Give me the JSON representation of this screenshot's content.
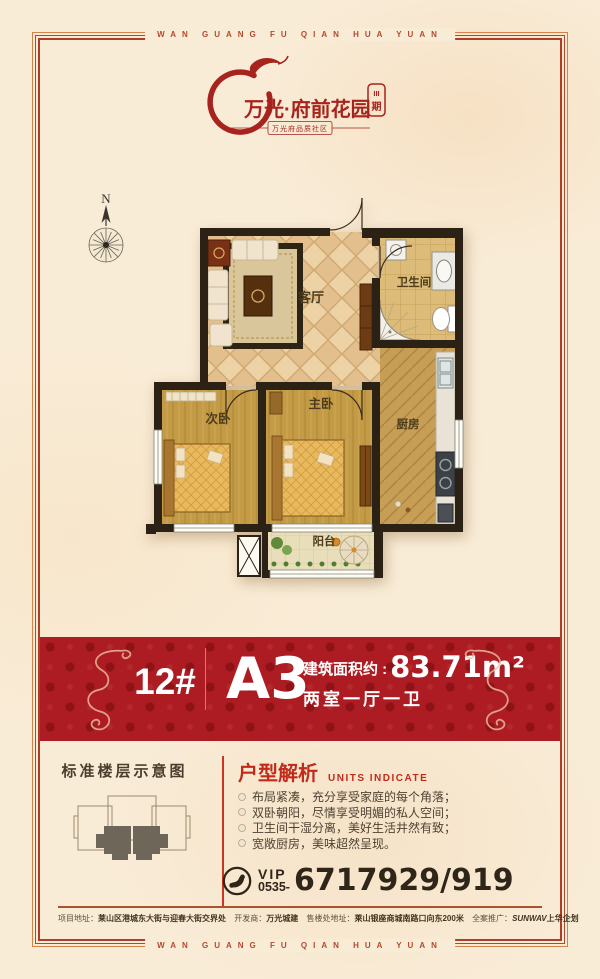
{
  "border": {
    "top_text": "WAN GUANG FU QIAN HUA YUAN",
    "bottom_text": "WAN GUANG FU QIAN HUA YUAN"
  },
  "logo": {
    "title": "万光·府前花园",
    "phase_line1": "III",
    "phase_line2": "期",
    "tagline": "万光府品质社区"
  },
  "compass": {
    "north_label": "N"
  },
  "floorplan": {
    "rooms": {
      "living": "客厅",
      "bathroom": "卫生间",
      "kitchen": "厨房",
      "master_bedroom": "主卧",
      "second_bedroom": "次卧",
      "balcony": "阳台"
    }
  },
  "banner": {
    "building_no": "12#",
    "unit_code": "A3",
    "area_label": "建筑面积约 :",
    "area_value": "83.71m²",
    "layout_desc": "两室一厅一卫"
  },
  "floor_diagram": {
    "title": "标准楼层示意图"
  },
  "analysis": {
    "title": "户型解析",
    "subtitle": "UNITS INDICATE",
    "points": [
      "布局紧凑，充分享受家庭的每个角落；",
      "双卧朝阳，尽情享受明媚的私人空间；",
      "卫生间干湿分离，美好生活井然有致；",
      "宽敞厨房，美味超然呈现。"
    ]
  },
  "phone": {
    "vip_label": "VIP",
    "area_code": "0535-",
    "number": "6717929/919"
  },
  "footer": {
    "project_label": "项目地址：",
    "project_value": "莱山区港城东大街与迎春大街交界处",
    "developer_label": "开发商：",
    "developer_value": "万光城建",
    "sales_label": "售楼处地址：",
    "sales_value": "莱山银座商城南路口向东200米",
    "agency_label": "全案推广：",
    "agency_brand": "SUNWAV",
    "agency_value": "上华企划"
  },
  "colors": {
    "accent_red": "#ac1c22",
    "frame_red": "#b3492c",
    "paper": "#f9ecd7",
    "wall_dark": "#2b2114"
  }
}
